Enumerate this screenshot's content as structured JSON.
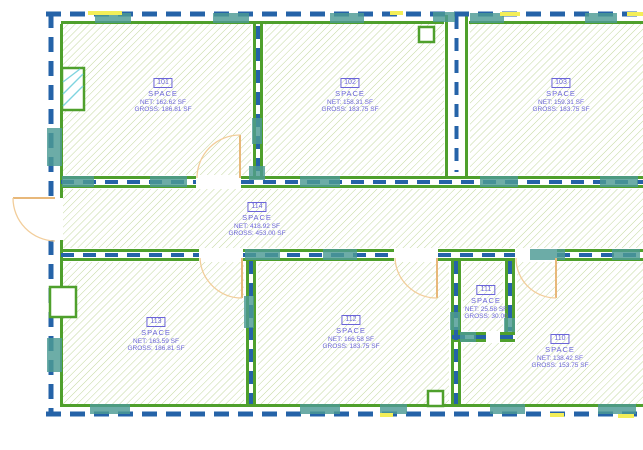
{
  "plan": {
    "title": "floor-plan-space-layout",
    "rooms": [
      {
        "number": "101",
        "name": "SPACE",
        "net": "NET: 162.62 SF",
        "gross": "GROSS: 186.81 SF"
      },
      {
        "number": "102",
        "name": "SPACE",
        "net": "NET: 158.31 SF",
        "gross": "GROSS: 183.75 SF"
      },
      {
        "number": "103",
        "name": "SPACE",
        "net": "NET: 159.31 SF",
        "gross": "GROSS: 183.75 SF"
      },
      {
        "number": "114",
        "name": "SPACE",
        "net": "NET: 418.92 SF",
        "gross": "GROSS: 453.00 SF"
      },
      {
        "number": "113",
        "name": "SPACE",
        "net": "NET: 163.59 SF",
        "gross": "GROSS: 186.81 SF"
      },
      {
        "number": "112",
        "name": "SPACE",
        "net": "NET: 166.58 SF",
        "gross": "GROSS: 183.75 SF"
      },
      {
        "number": "111",
        "name": "SPACE",
        "net": "NET: 25.58 SF",
        "gross": "GROSS: 30.00"
      },
      {
        "number": "110",
        "name": "SPACE",
        "net": "NET: 138.42 SF",
        "gross": "GROSS: 153.75 SF"
      }
    ],
    "colors": {
      "wall_green": "#4fa02c",
      "boundary_blue": "#2563a8",
      "hatch_green": "#bcd494",
      "label_blue": "#6b65d8",
      "door_tan": "#eebd80",
      "glazing_teal": "#4d9b94",
      "highlight_yellow": "#f3ee58",
      "window_cyan": "#7fd4df"
    }
  }
}
